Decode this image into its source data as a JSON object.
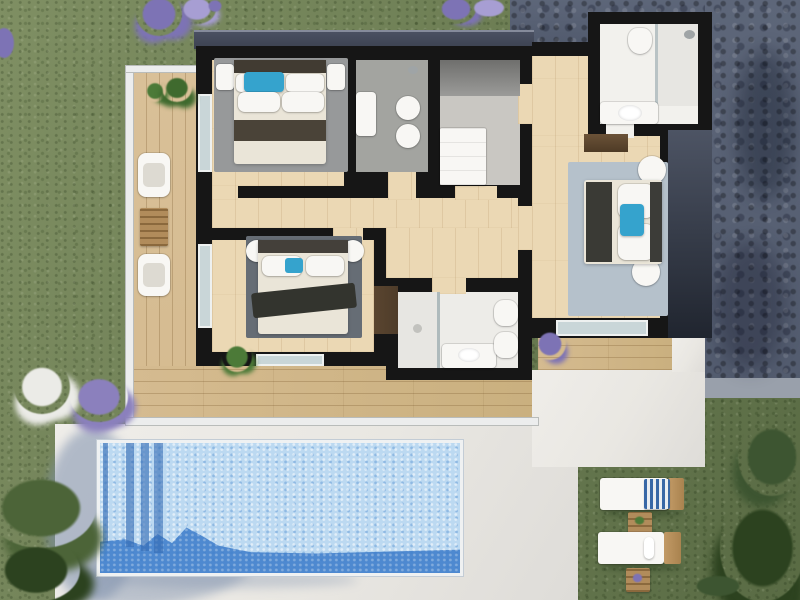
{
  "scene": {
    "description": "Photorealistic top-down 3D rendering of a villa upper floor plan with three bedrooms, three bathrooms, walk-in closet, wrap-around wooden terrace with glass balustrade, white paved patio, rectangular swimming pool, lawn with lavender and flowering shrubs, grey stone paved driveway and a sun deck with two loungers",
    "view": "top-down plan view",
    "style": "architectural 3D render, no visible text"
  },
  "building": {
    "rooms": [
      {
        "id": "bedroom-1",
        "name": "Bedroom top-left",
        "furniture": [
          "double bed with cream duvet and dark runner",
          "blue accent pillow",
          "two white nightstands",
          "grey rug",
          "dark headboard"
        ]
      },
      {
        "id": "bathroom-1",
        "name": "Bathroom top-centre",
        "furniture": [
          "wall basin",
          "toilet",
          "bidet",
          "shower head"
        ],
        "floor": "grey tile"
      },
      {
        "id": "walk-in-closet",
        "name": "Walk-in closet",
        "furniture": [
          "dark wardrobe",
          "white dresser"
        ]
      },
      {
        "id": "bedroom-2",
        "name": "Bedroom centre",
        "furniture": [
          "double bed with dark throw",
          "blue accent pillow",
          "two round white nightstands",
          "dark grey rug",
          "potted green plant"
        ]
      },
      {
        "id": "bathroom-2",
        "name": "Bathroom bottom-centre",
        "furniture": [
          "walk-in shower with glass screen",
          "vanity basin",
          "toilet",
          "bidet",
          "dark brown cabinet"
        ]
      },
      {
        "id": "hallway",
        "name": "Hallway with light wood flooring",
        "furniture": []
      },
      {
        "id": "bathroom-3",
        "name": "Bathroom top-right wing",
        "furniture": [
          "toilet",
          "walk-in shower with glass screen and shower head",
          "vanity with basin"
        ]
      },
      {
        "id": "bedroom-3",
        "name": "Bedroom right wing",
        "furniture": [
          "double bed turned sideways with dark runner",
          "blue accent pillow",
          "two round white side tables",
          "light blue-grey rug",
          "dark wood sideboard"
        ]
      }
    ],
    "walls": "black on plan",
    "roof_edge": "dark slate eave band along north facade and east wing"
  },
  "outdoor": {
    "features": [
      {
        "id": "terrace",
        "name": "L-shaped wooden terrace with white glass balustrade",
        "items": [
          "two white armchairs",
          "slatted wooden table",
          "two green shrubs in planters",
          "lavender pot at south-east corner"
        ]
      },
      {
        "id": "patio",
        "name": "White paved patio with tree shadows"
      },
      {
        "id": "pool",
        "name": "Rectangular mosaic-tiled swimming pool",
        "items": [
          "four railing shadows on left",
          "large blue shade across south end"
        ]
      },
      {
        "id": "driveway",
        "name": "Grey stone paver driveway along north and east sides"
      },
      {
        "id": "lawn",
        "name": "Green lawn",
        "items": [
          "lavender clumps along top edge",
          "white and purple flowering shrubs mid-left",
          "dark green bushes bottom-left and bottom-right"
        ]
      },
      {
        "id": "sun-deck",
        "name": "Lawn sun area",
        "items": [
          "sun lounger with blue striped towel",
          "sun lounger with rolled white towel",
          "two slatted side tables with small plants"
        ]
      }
    ]
  },
  "colors": {
    "grass": "#6e7f55",
    "grass-light": "#7f8f63",
    "grass-dark": "#596b44",
    "bush": "#3d5531",
    "bush-dark": "#2c421f",
    "lavender": "#7d73b5",
    "lavender-light": "#a79ed3",
    "flower-white": "#ebebe7",
    "paver": "#5d6679",
    "paver-light": "#99a0ab",
    "patio": "#e9e7e2",
    "shadow-blue": "#7e90ad",
    "pool": "#bcd9f1",
    "pool-shadow": "#3f7ecb",
    "deck": "#d5bb90",
    "wood": "#ebd8b4",
    "wall": "#161616",
    "eave": "#3c4251",
    "wing-wall-top": "#4d5464",
    "wing-wall-bottom": "#20252f",
    "bath-floor": "#a3a4a0",
    "closet-floor": "#c9c7c2",
    "fixture": "#f8f7f4",
    "shower-floor": "#e7e6e2",
    "rug1": "#97999a",
    "rug2": "#666d75",
    "rug3": "#b5c1cb",
    "sheet": "#eae5d8",
    "band1": "#4a4338",
    "band2": "#33342e",
    "band3": "#3a3a35",
    "headboard": "#413b32",
    "accent": "#35a3cd",
    "glass": "#c9d6d8",
    "cabinet-brown": "#4e3c2a",
    "table-wood": "#b18c5b",
    "plant": "#4c7a38"
  }
}
